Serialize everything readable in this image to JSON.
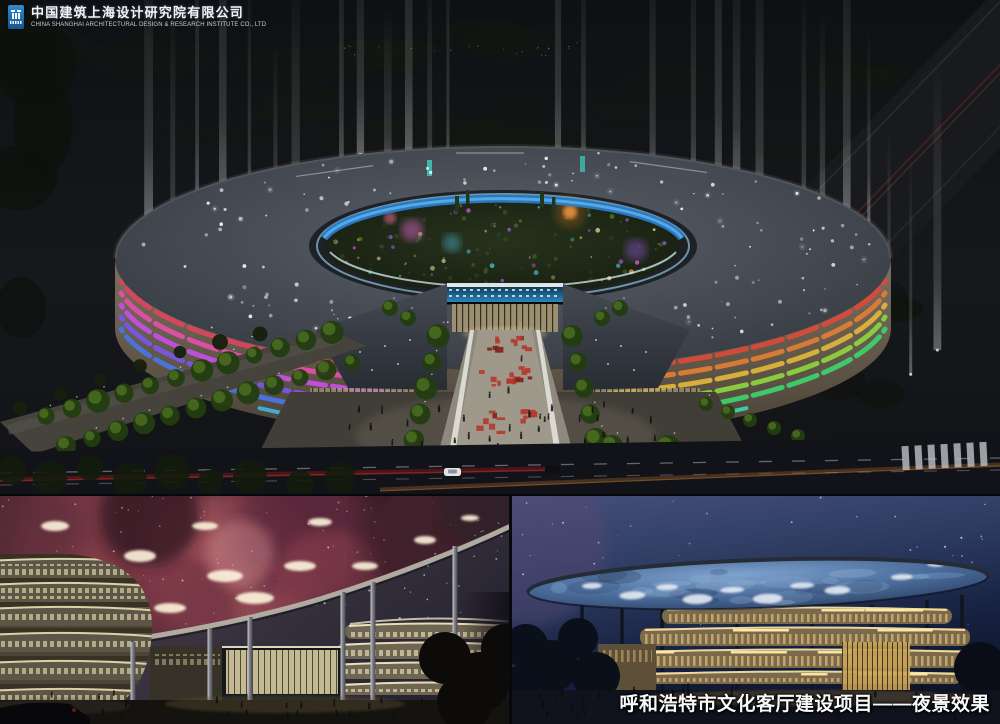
{
  "branding": {
    "company_name_zh": "中国建筑上海设计研究院有限公司",
    "company_name_en": "CHINA SHANGHAI ARCHITECTURAL DESIGN & RESEARCH INSTITUTE CO., LTD"
  },
  "caption": {
    "text": "呼和浩特市文化客厅建设项目——夜景效果"
  },
  "palette": {
    "logo_blue": "#1d6db5",
    "left_wing_bands": [
      "#d8455f",
      "#e14fa8",
      "#c44fe0",
      "#7a55e8",
      "#4a74e0",
      "#3fb0e0"
    ],
    "right_wing_bands": [
      "#d84a3a",
      "#de7c36",
      "#dcb33c",
      "#8cd23e",
      "#3ecf6e",
      "#3ecfae"
    ],
    "inner_ring_glass": "#2f7fd0",
    "nebula_ceiling": "#a85560",
    "disc_ceiling": "#4a6b99",
    "floor_band_glow": "#f2dea0"
  }
}
